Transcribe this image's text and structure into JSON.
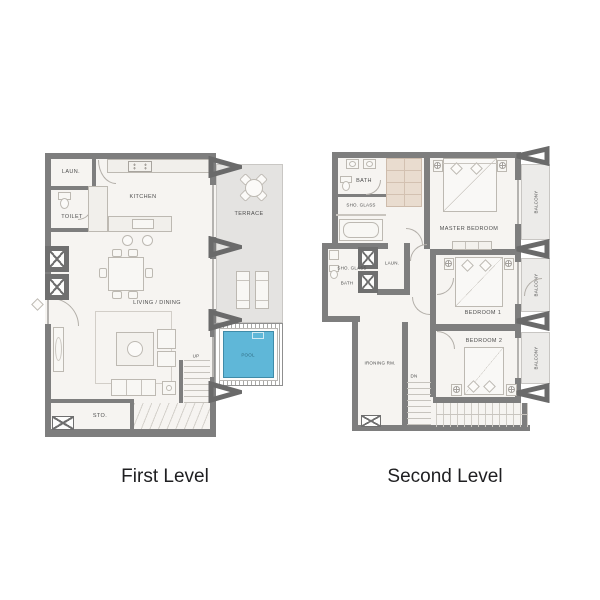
{
  "captions": {
    "first": "First Level",
    "second": "Second Level"
  },
  "first_level": {
    "laundry": "LAUN.",
    "toilet": "TOILET",
    "kitchen": "KITCHEN",
    "living_dining": "LIVING / DINING",
    "storage": "STO.",
    "terrace": "TERRACE",
    "pool": "POOL",
    "stairs_up": "UP"
  },
  "second_level": {
    "bath_upper": "BATH",
    "shower_upper": "SHO. GLASS",
    "master_bedroom": "MASTER BEDROOM",
    "shower_mid": "SHO. GLASS",
    "bath_mid": "BATH",
    "laundry": "LAUN.",
    "bedroom1": "BEDROOM 1",
    "bedroom2": "BEDROOM 2",
    "ironing_room": "IRONING RM.",
    "stairs_down": "DN",
    "balcony_master": "BALCONY",
    "balcony_bedroom1": "BALCONY",
    "balcony_bedroom2": "BALCONY"
  },
  "colors": {
    "wall": "#7e7e7e",
    "floor": "#f6f4f1",
    "terrace": "#e4e3e1",
    "balcony": "#ecebe9",
    "pool_water": "#5fb7d8",
    "closet_cabinet": "#e9dccf",
    "caption_text": "#1f1f21"
  }
}
